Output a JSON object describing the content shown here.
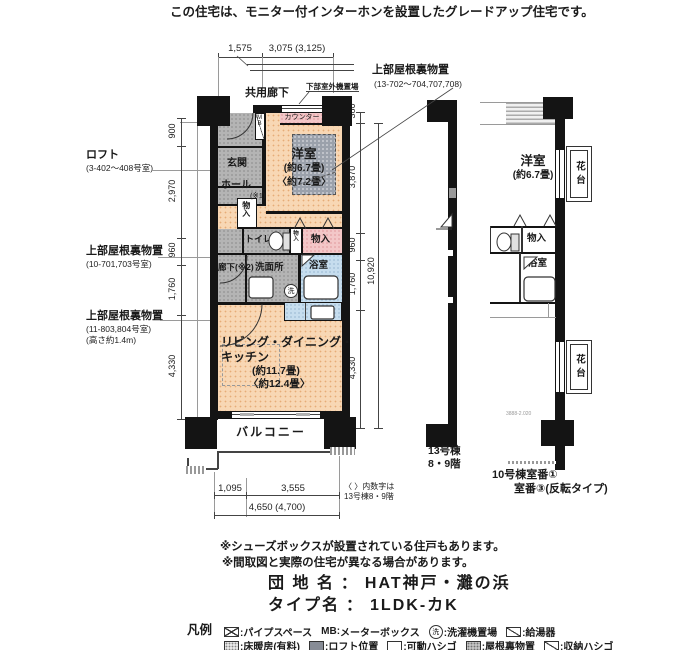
{
  "page": {
    "top_note": "この住宅は、モニター付インターホンを設置したグレードアップ住宅です。"
  },
  "dimensions": {
    "top": {
      "d1": "1,575",
      "d2": "3,075 (3,125)"
    },
    "left": {
      "d1": "900",
      "d2": "2,970",
      "d3": "960",
      "d4": "1,760",
      "d5": "4,330"
    },
    "right": {
      "d1": "380",
      "d2": "3,870",
      "d3": "960",
      "d4": "1,760",
      "d5": "4,330",
      "total": "10,920"
    },
    "bottom": {
      "d1": "1,095",
      "d2": "3,555",
      "total": "4,650 (4,700)",
      "note1": "〈 〉内数字は",
      "note2": "13号棟8・9階"
    }
  },
  "labels_left": {
    "loft_title": "ロフト",
    "loft_rooms": "(3-402〜408号室)",
    "attic1_title": "上部屋根裏物置",
    "attic1_rooms": "(10-701,703号室)",
    "attic2_title": "上部屋根裏物置",
    "attic2_rooms": "(11-803,804号室)",
    "attic2_height": "(高さ約1.4m)"
  },
  "label_top_right": {
    "title": "上部屋根裏物置",
    "rooms": "(13-702〜704,707,708)"
  },
  "main_plan": {
    "corridor": "共用廊下",
    "outdoor_unit": "下部室外機置場",
    "counter": "カウンター",
    "mb": "MB",
    "entrance": "玄関",
    "hall": "ホール",
    "note1": "(※1)",
    "yoshitsu": "洋室",
    "yoshitsu_size": "(約6.7畳)",
    "yoshitsu_size_alt": "〈約7.2畳〉",
    "monoire_top": "物入",
    "toilet": "トイレ",
    "monoire_small": "物入",
    "monoire_right": "物入",
    "rouka": "廊下(※2)",
    "senmenjo": "洗面所",
    "wash_mark": "洗",
    "bathroom": "浴室",
    "ldk1": "リビング・ダイニング・",
    "ldk2": "キッチン",
    "ldk_size": "(約11.7畳)",
    "ldk_size_alt": "〈約12.4畳〉",
    "balcony": "バルコニー"
  },
  "right_plan": {
    "yoshitsu": "洋室",
    "yoshitsu_size": "(約6.7畳)",
    "kadai_top": "花台",
    "kadai_bottom": "花台",
    "monoire": "物入",
    "bathroom": "浴室",
    "faint_mark": "3888-2.020",
    "b13_line1": "13号棟",
    "b13_line2": "8・9階",
    "b10_line1": "10号棟室番①",
    "b10_line2": "室番③(反転タイプ)"
  },
  "notes": {
    "n1": "※シューズボックスが設置されている住戸もあります。",
    "n2": "※間取図と実際の住宅が異なる場合があります。"
  },
  "estate": {
    "danchi_label": "団 地 名",
    "danchi_colon": "：",
    "danchi_name": "HAT神戸・灘の浜",
    "type_label": "タイプ名",
    "type_colon": "：",
    "type_name": "1LDK-カK"
  },
  "legend": {
    "title": "凡例",
    "mb_label": "MB:",
    "wash_mark": "洗",
    "r1t1": ":パイプスペース",
    "r1t2": "メーターボックス",
    "r1t3": ":洗濯機置場",
    "r1t4": ":給湯器",
    "r2t1": ":床暖房(有料)",
    "r2t2": ":ロフト位置",
    "r2t3": ":可動ハシゴ",
    "r2t4": ":屋根裏物置",
    "r2t5": ":収納ハシゴ"
  }
}
